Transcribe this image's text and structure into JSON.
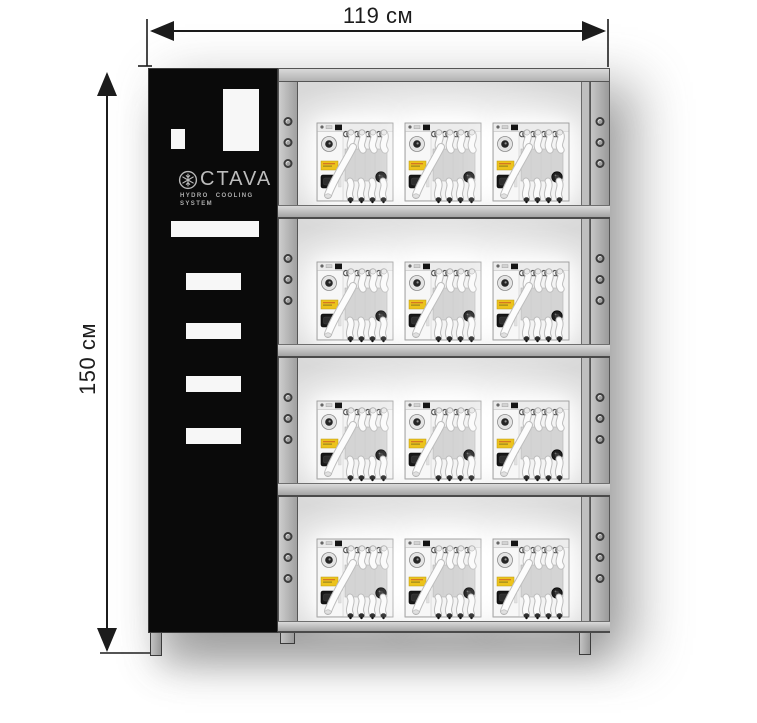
{
  "dimensions": {
    "width_label": "119 см",
    "height_label": "150 см"
  },
  "brand": {
    "name": "OCTAVA",
    "wordmark": "CTAVA",
    "logo_icon": "snowflake-in-circle",
    "tagline_line1": "HYDRO COOLING",
    "tagline_line2": "SYSTEM"
  },
  "rack": {
    "shelf_count": 4,
    "units_per_shelf": 3,
    "holes_per_section_per_rail": 3,
    "unit_type": "hydro-cooling-module"
  },
  "colors": {
    "frame_gray": "#b2b2b2",
    "panel_black": "#0a0a0a",
    "module_label_yellow": "#ecc31d",
    "dimension_line": "#1c1c1c"
  }
}
